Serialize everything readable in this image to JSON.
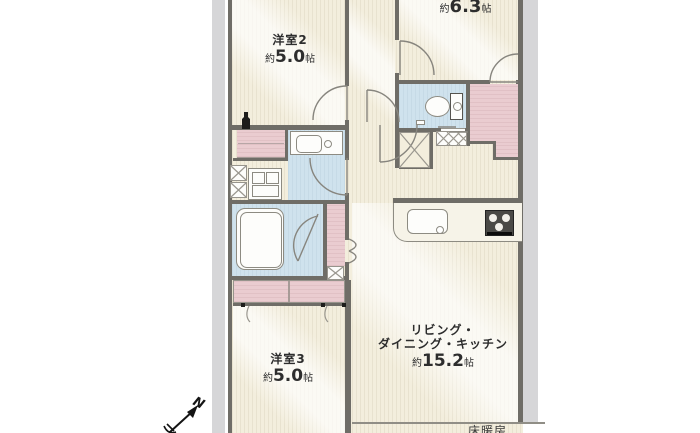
{
  "plan": {
    "rooms": {
      "bedroom2": {
        "name": "洋室2",
        "size_prefix": "約",
        "size_value": "5.0",
        "size_unit": "帖"
      },
      "bedroom1": {
        "size_prefix": "約",
        "size_value": "6.3",
        "size_unit": "帖"
      },
      "bedroom3": {
        "name": "洋室3",
        "size_prefix": "約",
        "size_value": "5.0",
        "size_unit": "帖"
      },
      "ldk": {
        "name_line1": "リビング・",
        "name_line2": "ダイニング・キッチン",
        "size_prefix": "約",
        "size_value": "15.2",
        "size_unit": "帖"
      }
    },
    "labels": {
      "floor_heating": "床暖房",
      "compass_north": "N"
    },
    "icons": [
      "toilet-icon",
      "bathtub-icon",
      "kitchen-sink-icon",
      "stove-icon",
      "washbasin-icon",
      "vanity-icon",
      "north-arrow-icon",
      "bottle-icon",
      "entrance-mat",
      "closet-x",
      "washer-pan"
    ],
    "colors": {
      "floor_cream": "#f3eedd",
      "wet_area_blue": "#cfe2ed",
      "closet_pink": "#eaccd0",
      "wall_gray": "#6f6d67",
      "outside_strip_gray": "#d6d6d8",
      "text": "#2d2d2d"
    }
  }
}
